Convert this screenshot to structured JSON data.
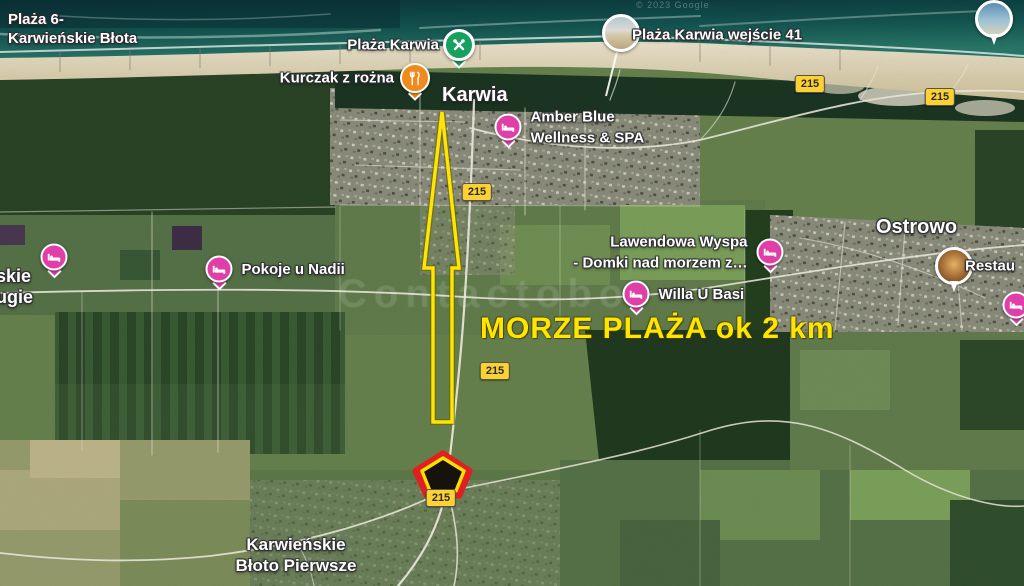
{
  "attribution": "© 2023 Google",
  "watermark": "Contactobo",
  "headline": "MORZE PLAŻA ok 2 km",
  "road_shield": "215",
  "towns": {
    "karwia": "Karwia",
    "ostrowo": "Ostrowo",
    "plaza6": {
      "line1": "Plaża 6-",
      "line2": "Karwieńskie Błota"
    },
    "bloto_pierwsze": {
      "line1": "Karwieńskie",
      "line2": "Błoto Pierwsze"
    },
    "bloto_drugie_partial": {
      "line1": "skie",
      "line2": "ugie"
    }
  },
  "pois": {
    "plaza_karwia": {
      "label": "Plaża Karwia",
      "type": "park"
    },
    "kurczak": {
      "label": "Kurczak z rożna",
      "type": "restaurant"
    },
    "amber": {
      "line1": "Amber Blue",
      "line2": "Wellness & SPA",
      "type": "lodging"
    },
    "wejscie41": {
      "label": "Plaża Karwia wejście 41",
      "type": "photo"
    },
    "pokoje": {
      "label": "Pokoje u Nadii",
      "type": "lodging"
    },
    "lawendowa": {
      "line1": "Lawendowa Wyspa",
      "line2": "- Domki nad morzem z…",
      "type": "lodging"
    },
    "willa": {
      "label": "Willa U Basi",
      "type": "lodging"
    },
    "restau_cut": {
      "label": "Restau",
      "type": "photo"
    }
  },
  "icons": {
    "lodging": "bed-icon",
    "restaurant": "fork-knife-icon",
    "park": "crossed-tools-icon",
    "photo": "photo-thumbnail",
    "property": "pentagon-outline-marker",
    "arrow": "distance-arrow-up"
  },
  "colors": {
    "lodging_pin": "#e03fa8",
    "restaurant_pin": "#ef8a1f",
    "park_pin": "#18a05e",
    "shield_bg": "#fcd232",
    "annotation_yellow": "#ffe600",
    "marker_red": "#e02020",
    "sea_dark": "#0b363c",
    "sand": "#e9dfc2"
  }
}
